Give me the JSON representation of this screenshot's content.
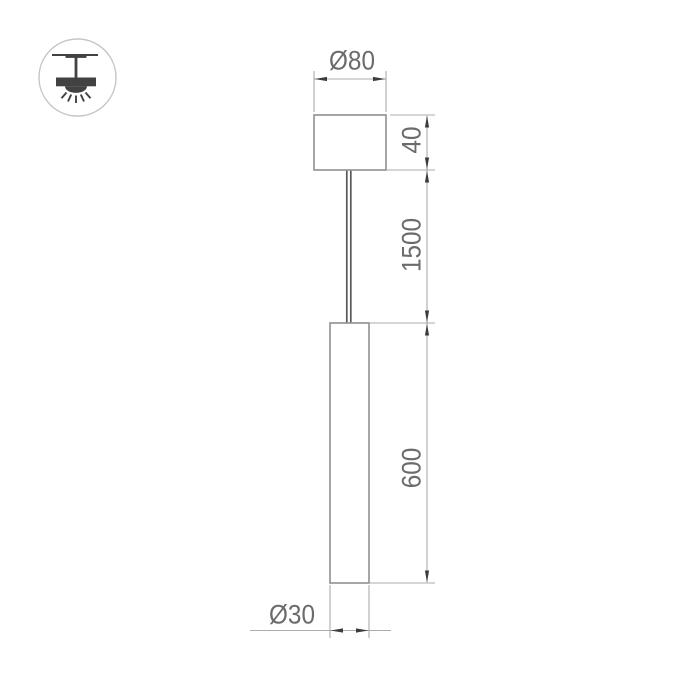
{
  "drawing": {
    "type": "pendant-lamp-dimension-drawing",
    "labels": {
      "canopy_diameter": "Ø80",
      "canopy_height": "40",
      "suspension_length": "1500",
      "tube_length": "600",
      "tube_diameter": "Ø30"
    },
    "colors": {
      "background": "#ffffff",
      "outline": "#8f8f8f",
      "dim_line": "#ababab",
      "arrow": "#3c3c3c",
      "wire": "#585858",
      "label": "#6b6b6b",
      "icon_dark": "#424242",
      "icon_circle": "#c5c5c5"
    },
    "icon": {
      "type": "ceiling-pendant-lamp-badge"
    }
  }
}
